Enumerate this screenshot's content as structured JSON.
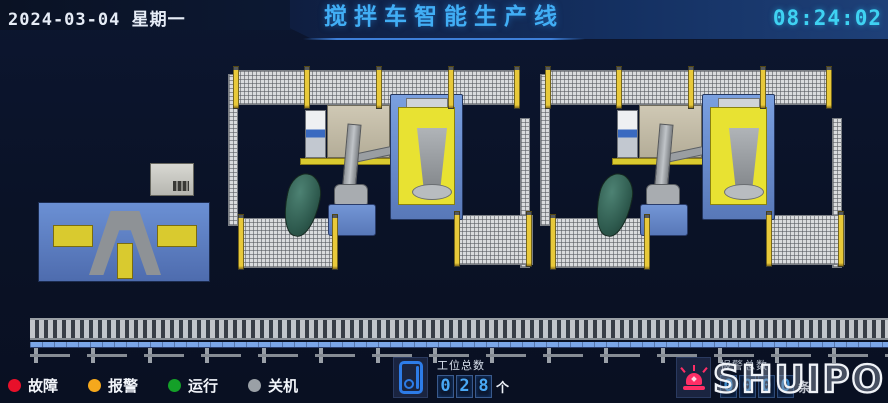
{
  "header": {
    "date": "2024-03-04  星期一",
    "title": "搅拌车智能生产线",
    "time": "08:24:02"
  },
  "colors": {
    "title": "#41aef5",
    "clock": "#3fd2f2",
    "fault": "#e8102a",
    "alarm": "#f5a81c",
    "running": "#14a028",
    "off": "#9aa0a6",
    "digit": "#49a8f5",
    "accent_blue": "#2d7ce8",
    "alarm_light": "#ff2e66"
  },
  "legend": {
    "items": [
      {
        "label": "故障",
        "status": "fault",
        "color": "#e8102a"
      },
      {
        "label": "报警",
        "status": "alarm",
        "color": "#f5a81c"
      },
      {
        "label": "运行",
        "status": "running",
        "color": "#14a028"
      },
      {
        "label": "关机",
        "status": "off",
        "color": "#9aa0a6"
      }
    ]
  },
  "counters": {
    "stations": {
      "label": "工位总数",
      "digits": [
        "0",
        "2",
        "8"
      ],
      "unit": "个"
    },
    "alarms": {
      "label": "报警总数",
      "digits": [
        "0",
        "0",
        "0",
        "0"
      ],
      "unit": "条"
    }
  },
  "logo": {
    "text": "SHUIPO"
  },
  "scene": {
    "cells": [
      {
        "id": "robot-cell-1"
      },
      {
        "id": "robot-cell-2"
      }
    ]
  }
}
